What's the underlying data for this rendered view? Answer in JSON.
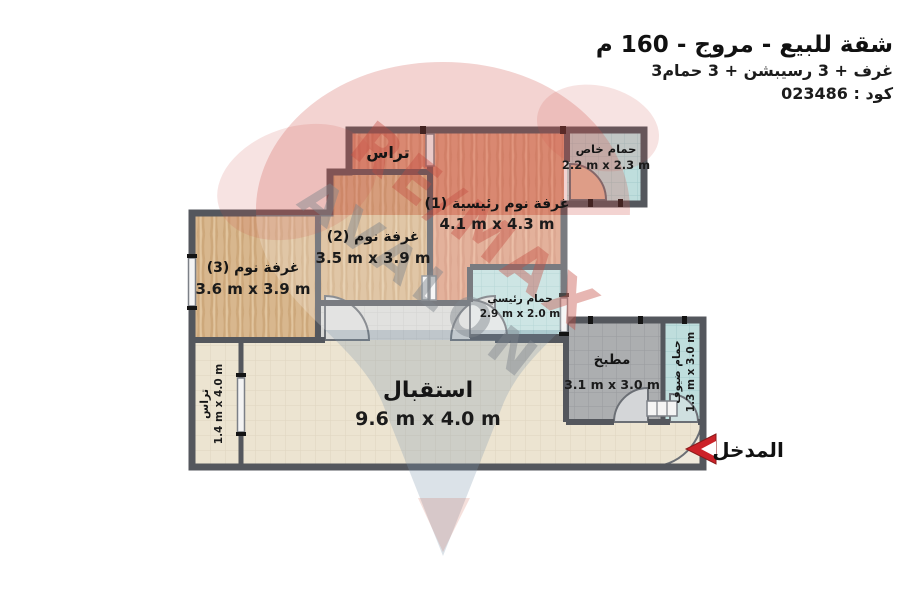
{
  "header": {
    "title": "شقة للبيع - مروج - 160 م",
    "subtitle": "3غرف + 3 رسيبشن + 3 حمام",
    "code": "كود : 023486"
  },
  "rooms": {
    "terrace_top": {
      "name": "تراس"
    },
    "bath_private": {
      "name": "حمام خاص",
      "dims": "2.2 m x 2.3 m"
    },
    "master": {
      "name": "غرفة نوم رئيسية (1)",
      "dims": "4.1 m x 4.3 m"
    },
    "bed2": {
      "name": "غرفة نوم (2)",
      "dims": "3.5 m x 3.9 m"
    },
    "bed3": {
      "name": "غرفة نوم (3)",
      "dims": "3.6 m x 3.9 m"
    },
    "bath_main": {
      "name": "حمام رئيسي",
      "dims": "2.9 m x 2.0 m"
    },
    "kitchen": {
      "name": "مطبخ",
      "dims": "3.1 m x 3.0 m"
    },
    "bath_guest": {
      "name": "حمام ضيوف",
      "dims": "1.3 m x 3.0 m"
    },
    "reception": {
      "name": "استقبال",
      "dims": "9.6 m x 4.0 m"
    },
    "terrace_left": {
      "name": "تراس",
      "dims": "1.4 m x 4.0 m"
    }
  },
  "entrance": {
    "label": "المدخل"
  },
  "watermark": {
    "brand": "RE/MAX",
    "agency": "AVALON"
  },
  "colors": {
    "wall": "#54575d",
    "wood_master": "#dc9b7f",
    "wood_bedroom": "#d8b78e",
    "tile_bath": "#bfdedd",
    "tile_kitchen": "#acaeb0",
    "tile_reception": "#ece4d1",
    "accent_red": "#cc2229",
    "watermark_red": "#c44c41",
    "watermark_gray": "#7e858c"
  }
}
